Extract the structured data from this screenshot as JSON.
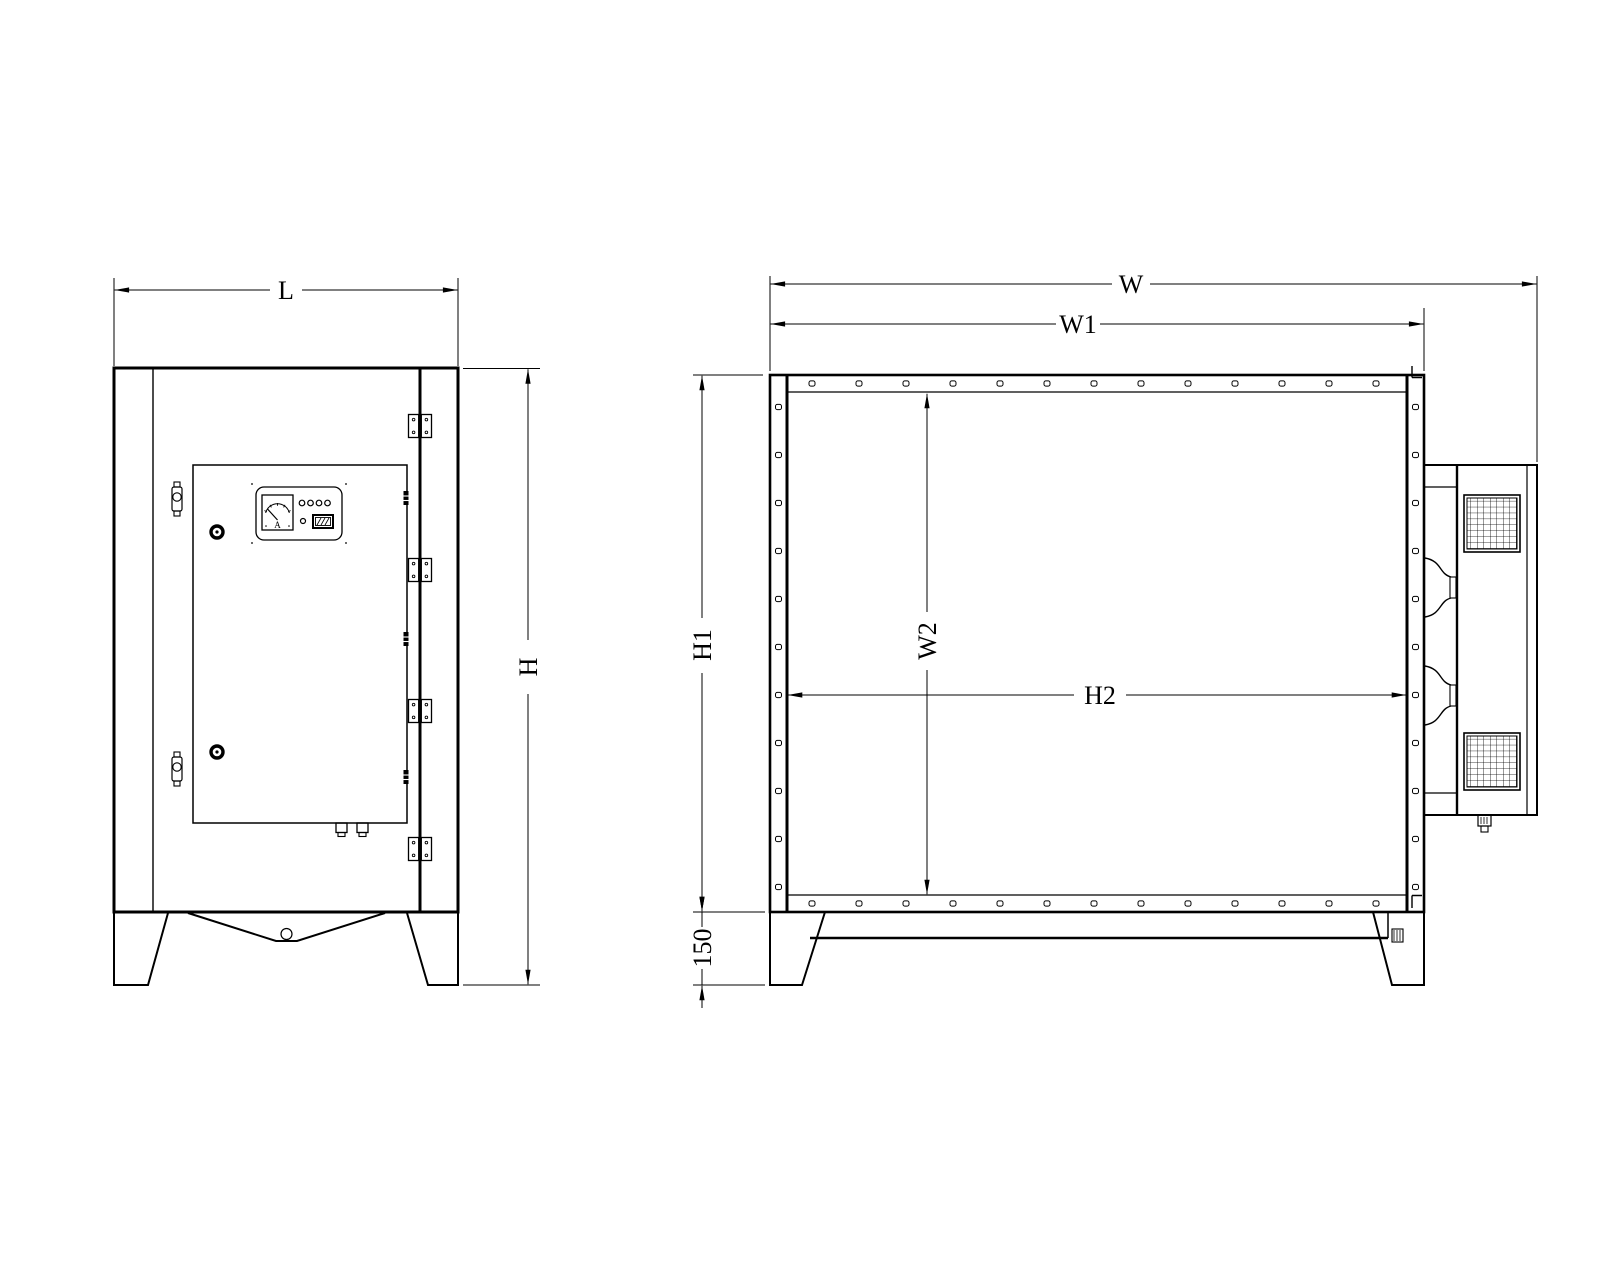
{
  "drawing": {
    "background": "#ffffff",
    "line_color": "#000000",
    "front_view": {
      "dim_width_label": "L",
      "dim_height_label": "H",
      "ammeter_label": "A"
    },
    "side_view": {
      "dim_overall_width_label": "W",
      "dim_body_width_label": "W1",
      "dim_height_label": "H1",
      "dim_inner_width_label": "W2",
      "dim_inner_span_label": "H2",
      "dim_leg_height_label": "150"
    }
  }
}
